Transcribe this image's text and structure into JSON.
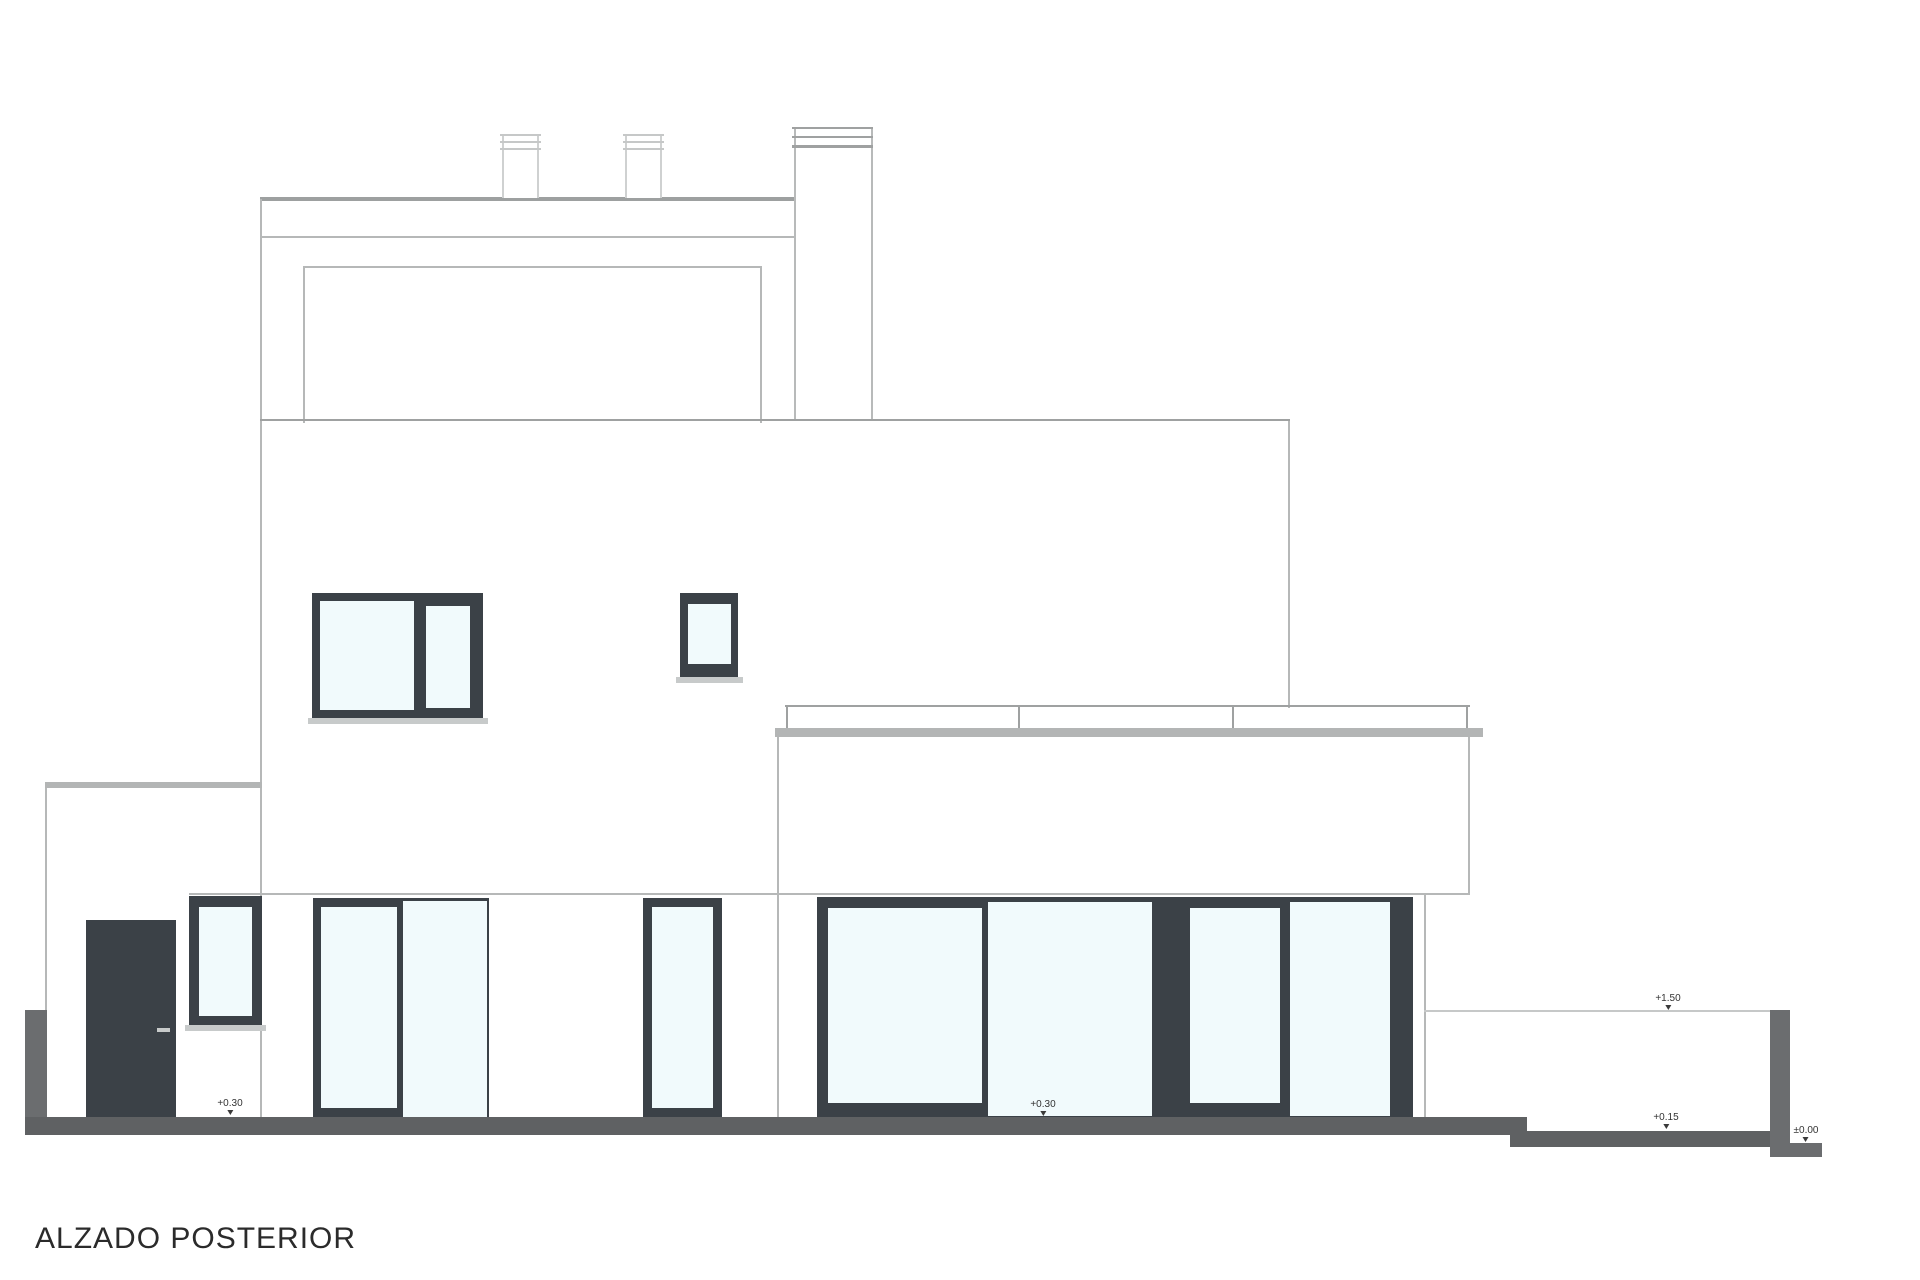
{
  "drawing_title": "ALZADO POSTERIOR",
  "level_markers": [
    {
      "name": "ground-floor-left",
      "label": "+0.30"
    },
    {
      "name": "ground-floor-center",
      "label": "+0.30"
    },
    {
      "name": "right-wall-top",
      "label": "+1.50"
    },
    {
      "name": "right-sidewalk",
      "label": "+0.15"
    },
    {
      "name": "site-datum",
      "label": "±0.00"
    }
  ],
  "colors": {
    "frame-dark": "#3b4147",
    "glazing": "#f1fafc",
    "ground": "#5f6163",
    "site-wall": "#6b6d6f",
    "outline": "#b6b8b8",
    "outline-mid": "#9fa1a1",
    "roof-edge": "#9da0a0",
    "sill": "#c7caca",
    "railing-band": "#b3b5b5",
    "chimney-line": "#c6c8c8",
    "text": "#333333"
  }
}
